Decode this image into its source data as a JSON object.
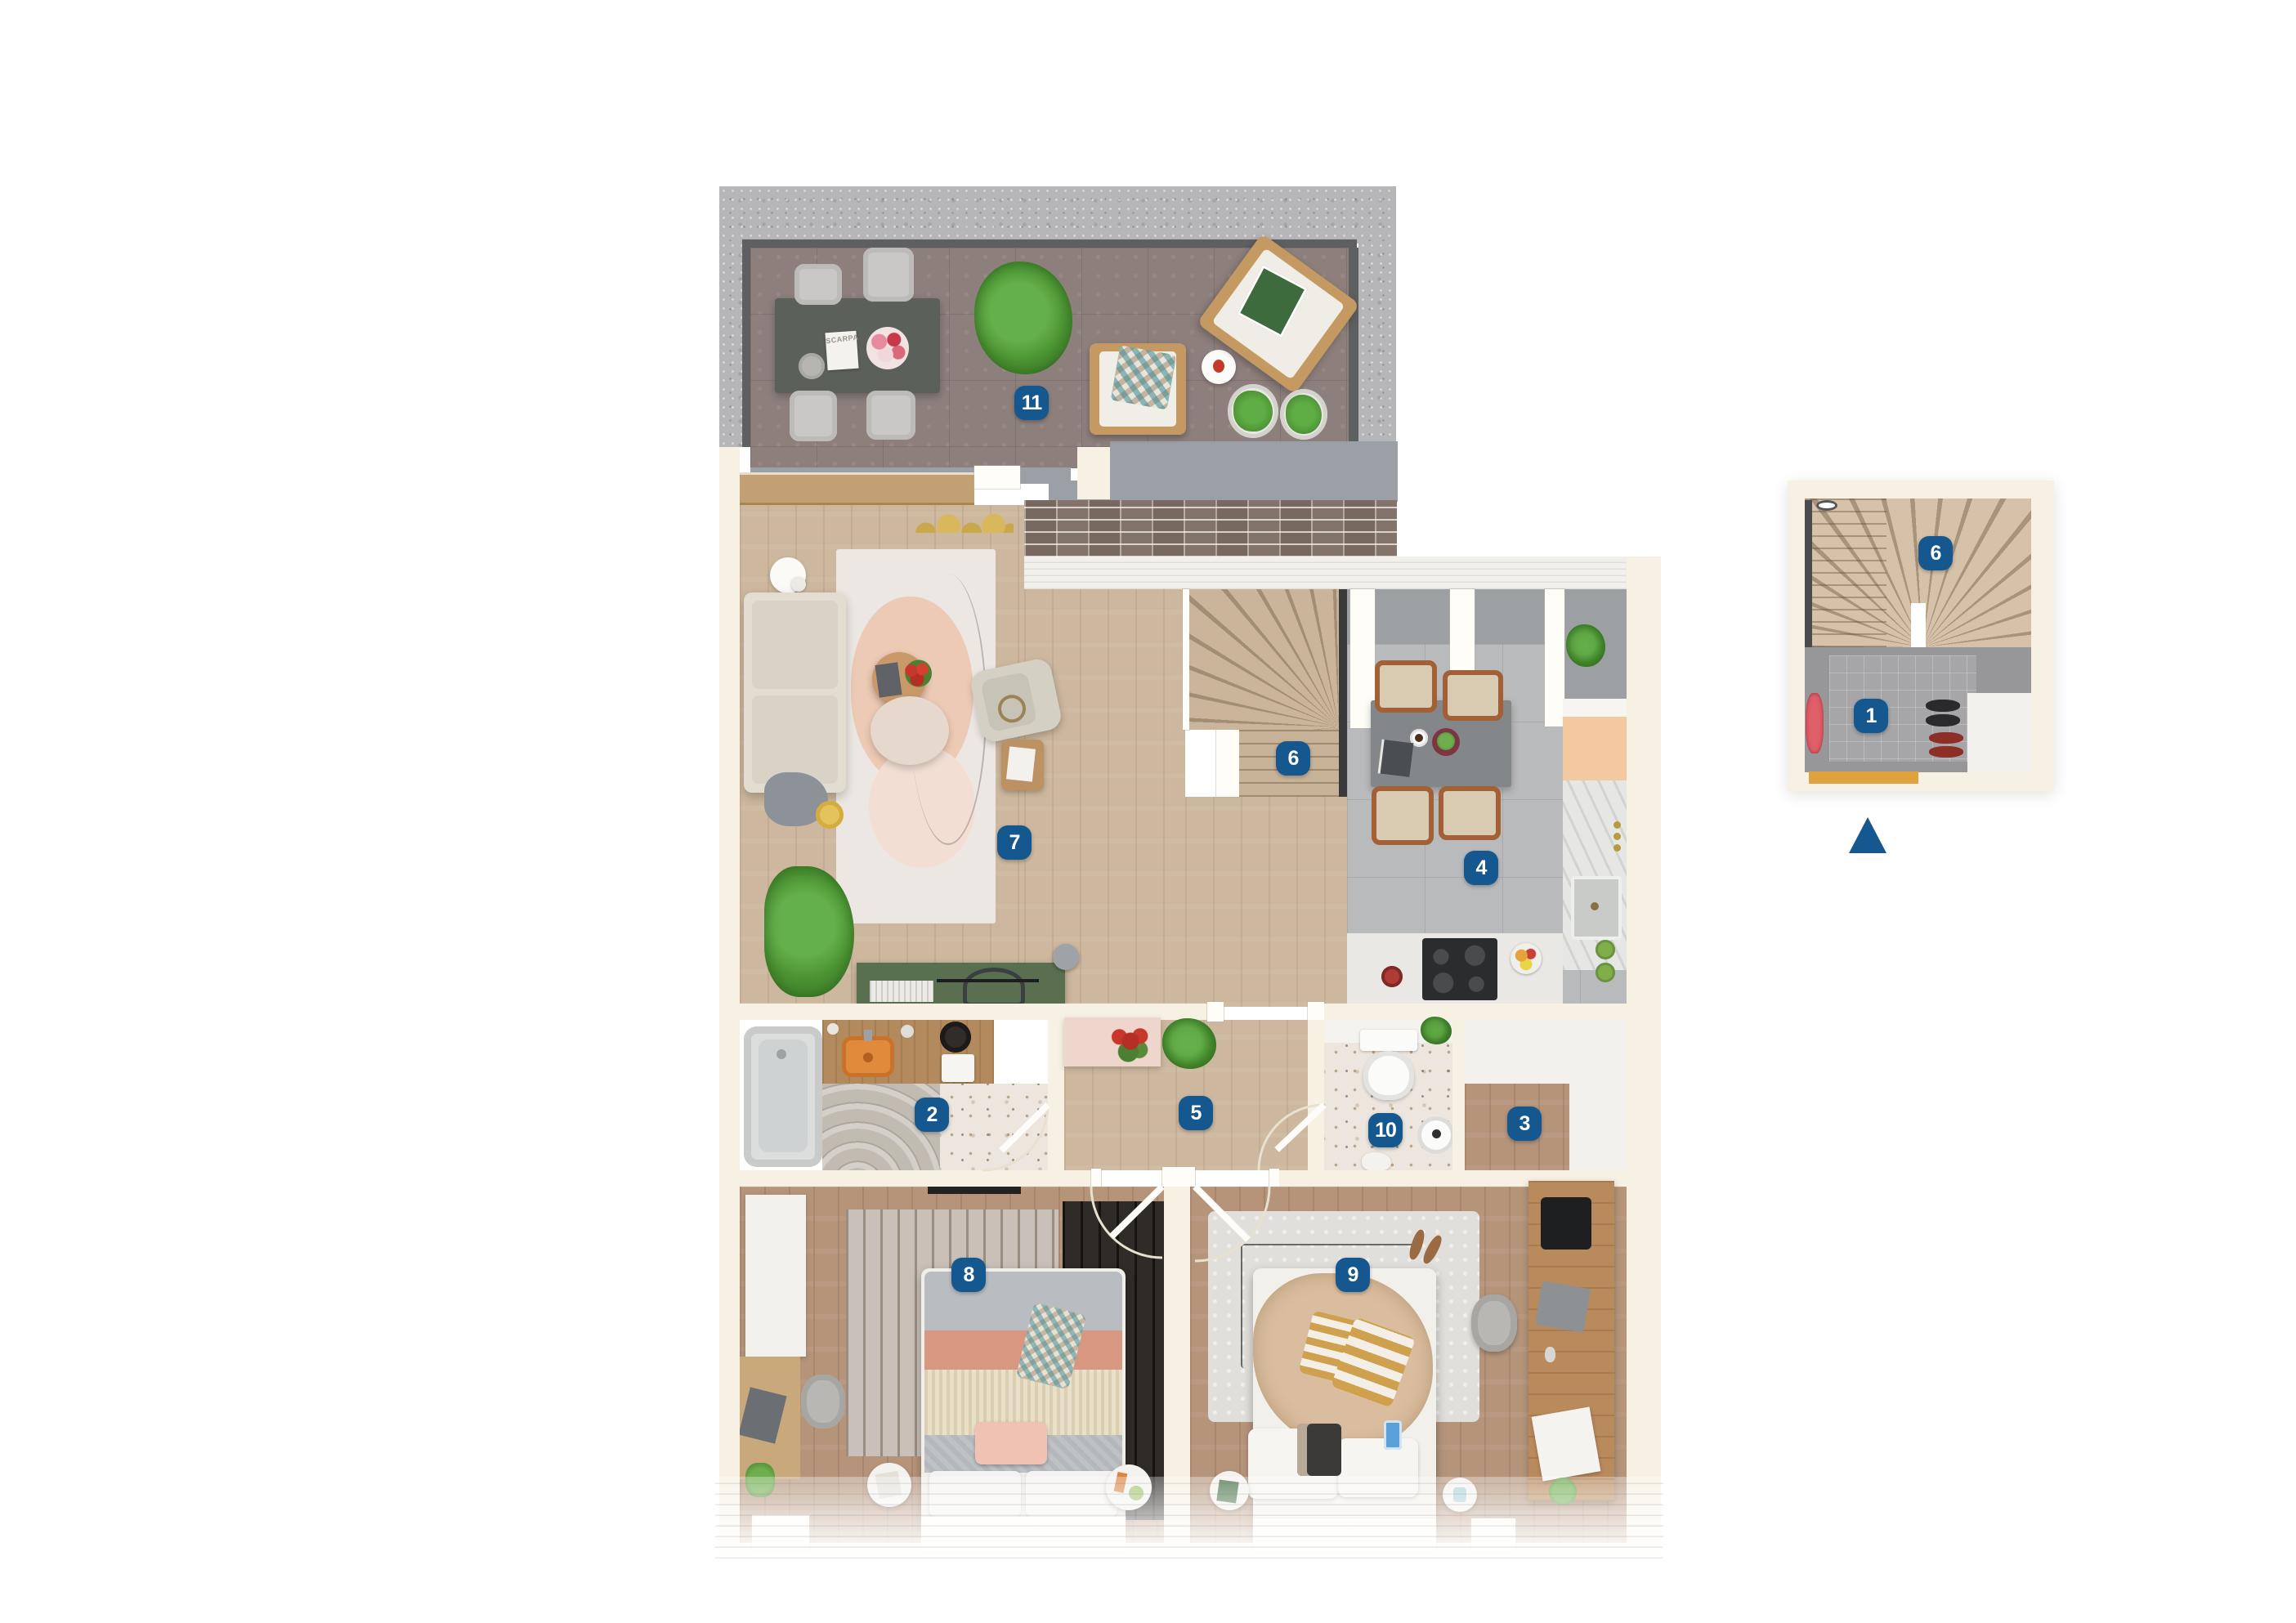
{
  "plan": {
    "badge_color": "#15578f",
    "rooms": {
      "terrace": {
        "number": "11"
      },
      "living_room": {
        "number": "7"
      },
      "stairs": {
        "number": "6"
      },
      "kitchen_dining": {
        "number": "4"
      },
      "bathroom": {
        "number": "2"
      },
      "hallway": {
        "number": "5"
      },
      "wc": {
        "number": "10"
      },
      "storage": {
        "number": "3"
      },
      "bedroom_left": {
        "number": "8"
      },
      "bedroom_right": {
        "number": "9"
      }
    },
    "inset": {
      "stairs": {
        "number": "6"
      },
      "entry": {
        "number": "1"
      }
    },
    "props": {
      "terrace_magazine_title": "SCARPA"
    }
  }
}
